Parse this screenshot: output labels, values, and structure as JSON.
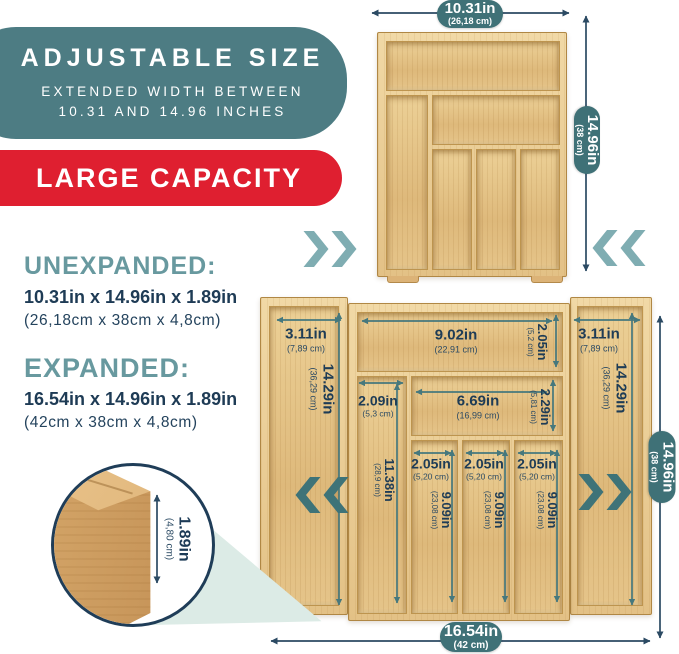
{
  "badge_adjustable": {
    "title": "ADJUSTABLE SIZE",
    "subtitle_line1": "EXTENDED WIDTH BETWEEN",
    "subtitle_line2": "10.31 AND 14.96 INCHES"
  },
  "badge_capacity": {
    "title": "LARGE CAPACITY"
  },
  "specs": {
    "unexpanded_heading": "UNEXPANDED:",
    "unexpanded_inches": "10.31in x 14.96in x 1.89in",
    "unexpanded_cm": "(26,18cm x 38cm x 4,8cm)",
    "expanded_heading": "EXPANDED:",
    "expanded_inches": "16.54in x 14.96in x 1.89in",
    "expanded_cm": "(42cm x 38cm x 4,8cm)"
  },
  "small_tray": {
    "width_in": "10.31in",
    "width_cm": "(26,18 cm)",
    "height_in": "14.96in",
    "height_cm": "(38 cm)"
  },
  "large_tray": {
    "width_in": "16.54in",
    "width_cm": "(42 cm)",
    "height_in": "14.96in",
    "height_cm": "(38 cm)",
    "side_panel_width_in": "3.11in",
    "side_panel_width_cm": "(7,89 cm)",
    "side_panel_height_in": "14.29in",
    "side_panel_height_cm": "(36,29 cm)",
    "top_comp_width_in": "9.02in",
    "top_comp_width_cm": "(22,91 cm)",
    "top_comp_height_in": "2.05in",
    "top_comp_height_cm": "(5,2 cm)",
    "left_col_width_in": "2.09in",
    "left_col_width_cm": "(5,3 cm)",
    "left_col_height_in": "11.38in",
    "left_col_height_cm": "(28,9 cm)",
    "mid_comp_width_in": "6.69in",
    "mid_comp_width_cm": "(16,99 cm)",
    "mid_comp_height_in": "2.29in",
    "mid_comp_height_cm": "(5,81 cm)",
    "slot_width_in": "2.05in",
    "slot_width_cm": "(5,20 cm)",
    "slot_height_in": "9.09in",
    "slot_height_cm": "(23,08 cm)"
  },
  "detail": {
    "thickness_in": "1.89in",
    "thickness_cm": "(4,80 cm)"
  },
  "icons": {
    "chevrons_right": "»",
    "chevrons_left": "«"
  },
  "colors": {
    "teal_badge": "#4d7c83",
    "red_badge": "#df1f30",
    "heading_teal": "#68999f",
    "navy_text": "#1e3b55",
    "pill_teal": "#3f7177",
    "arrow_teal": "#46787d",
    "arrow_navy": "#2b4a63",
    "chevron_light": "#7fadb2",
    "chevron_dark": "#3e7378",
    "bamboo": "#e4c083"
  }
}
